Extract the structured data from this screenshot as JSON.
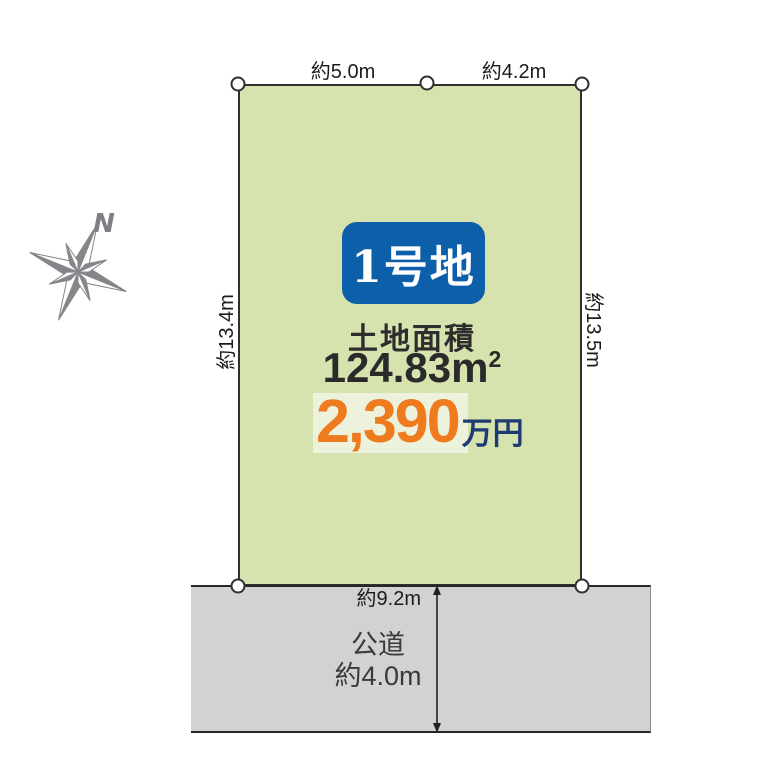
{
  "diagram": {
    "compass": {
      "letter": "N"
    },
    "plot": {
      "badge_label": "1号地",
      "area_label": "土地面積",
      "area_value": "124.83",
      "area_unit": "m",
      "area_exponent": "2",
      "price_value": "2,390",
      "price_unit": "万円"
    },
    "dimensions": {
      "top_left_edge": "約5.0m",
      "top_right_edge": "約4.2m",
      "left_edge": "約13.4m",
      "right_edge": "約13.5m",
      "bottom_edge": "約9.2m"
    },
    "road": {
      "name": "公道",
      "width": "約4.0m"
    },
    "colors": {
      "plot_fill": "#d6e3af",
      "road_fill": "#d2d2d4",
      "badge_bg": "#0c5fa8",
      "price_orange": "#ee7c1e",
      "price_navy": "#1e3a72",
      "compass_gray": "#85858a"
    }
  }
}
